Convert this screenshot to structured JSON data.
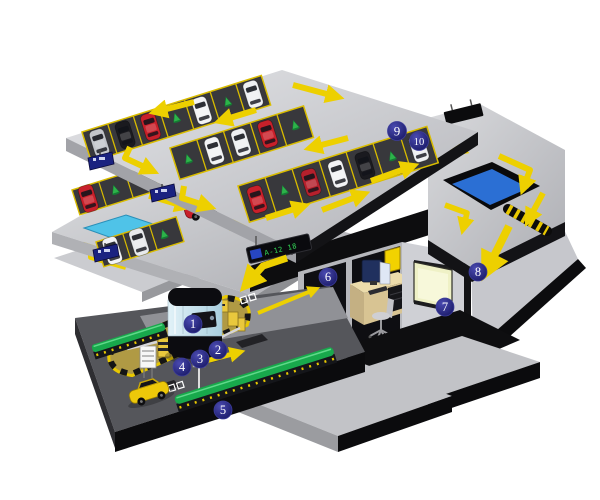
{
  "diagram": {
    "subject": "multi-level parking lot management system, isometric cutaway",
    "markers": [
      {
        "label": "1"
      },
      {
        "label": "2"
      },
      {
        "label": "3"
      },
      {
        "label": "4"
      },
      {
        "label": "5"
      },
      {
        "label": "6"
      },
      {
        "label": "7"
      },
      {
        "label": "8"
      },
      {
        "label": "9"
      },
      {
        "label": "10"
      }
    ],
    "led_display": {
      "text": "A-12 18"
    },
    "colors": {
      "arrow_yellow": "#edd000",
      "marker_navy": "#1d1d72",
      "deck_gray": "#c9cacd",
      "parking_bay_dark": "#38383c",
      "bay_line_yellow": "#d9bc00",
      "space_marker_green": "#2db34a",
      "divider_green": "#18a94c",
      "ramp_blue": "#2b6fd4",
      "ramp_cyan": "#4fc3e8",
      "island_tan": "#b09a44",
      "car_red": "#c8202a",
      "car_yellow": "#edc80a",
      "led_text_green": "#35e05a"
    }
  }
}
